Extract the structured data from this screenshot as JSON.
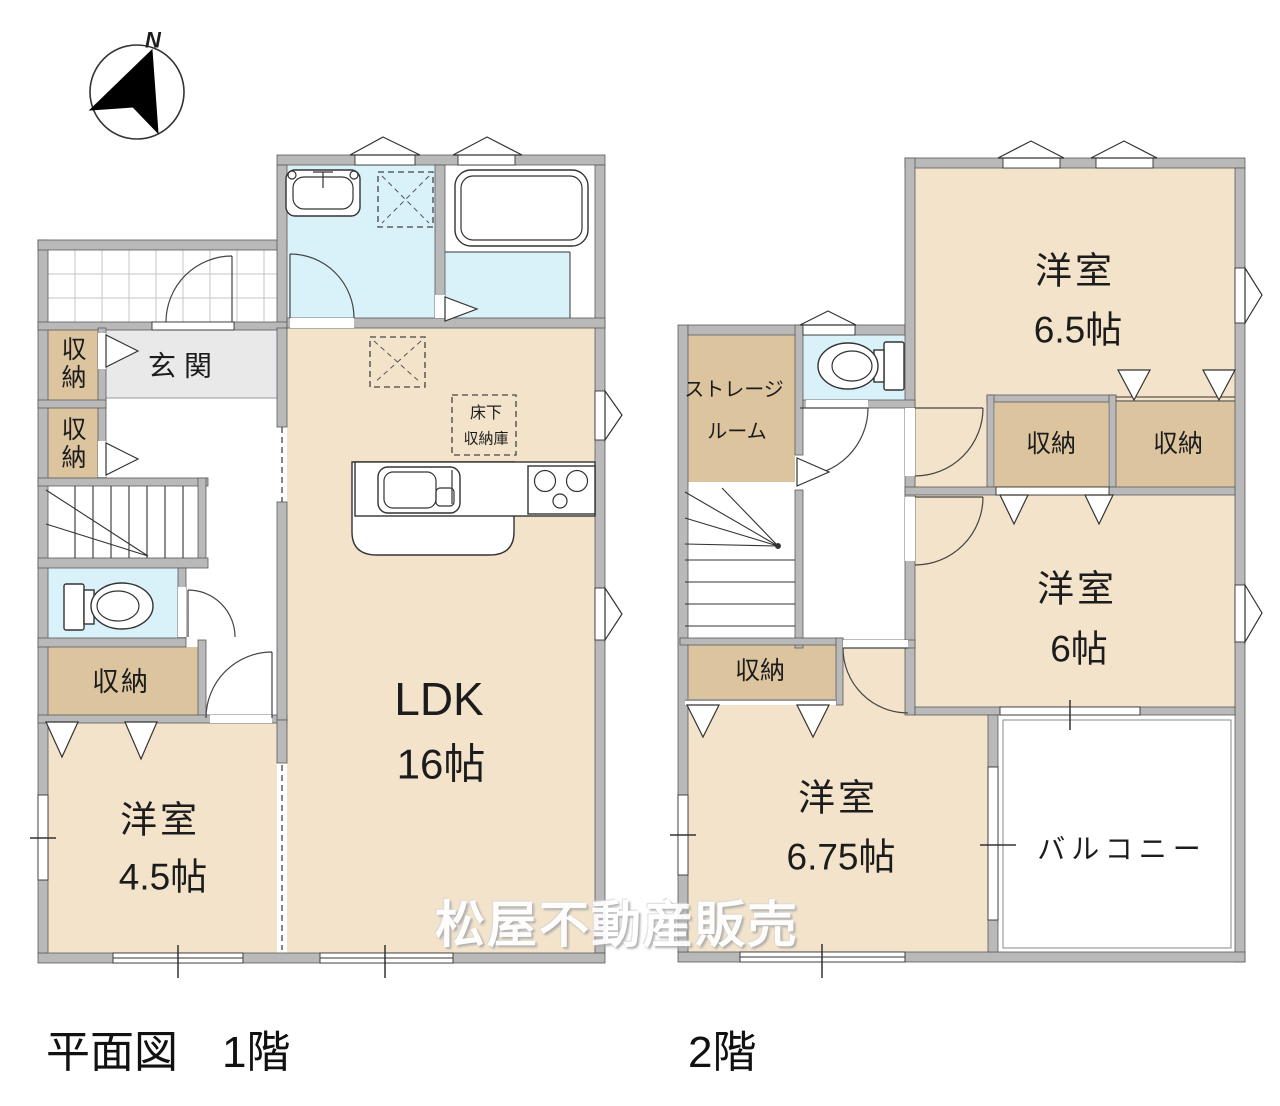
{
  "compass": {
    "north_label": "N"
  },
  "watermark": {
    "text": "松屋不動産販売"
  },
  "captions": {
    "floor1": "平面図　1階",
    "floor2": "2階"
  },
  "floor1": {
    "entrance": "玄関",
    "closet_top": "収納",
    "closet_mid": "収納",
    "closet_bottom": "収納",
    "ldk_name": "LDK",
    "ldk_size": "16帖",
    "bedroom_name": "洋室",
    "bedroom_size": "4.5帖",
    "underfloor_line1": "床下",
    "underfloor_line2": "収納庫"
  },
  "floor2": {
    "storage_line1": "ストレージ",
    "storage_line2": "ルーム",
    "closet_a": "収納",
    "closet_b": "収納",
    "closet_c": "収納",
    "bedroom65_name": "洋室",
    "bedroom65_size": "6.5帖",
    "bedroom6_name": "洋室",
    "bedroom6_size": "6帖",
    "bedroom675_name": "洋室",
    "bedroom675_size": "6.75帖",
    "balcony": "バルコニー"
  },
  "colors": {
    "room_floor": "#f3e3cb",
    "storage_floor": "#dcc49f",
    "wet_area": "#d9f1f8",
    "entrance_floor": "#e9e9e9",
    "wall": "#b9b9b9"
  }
}
